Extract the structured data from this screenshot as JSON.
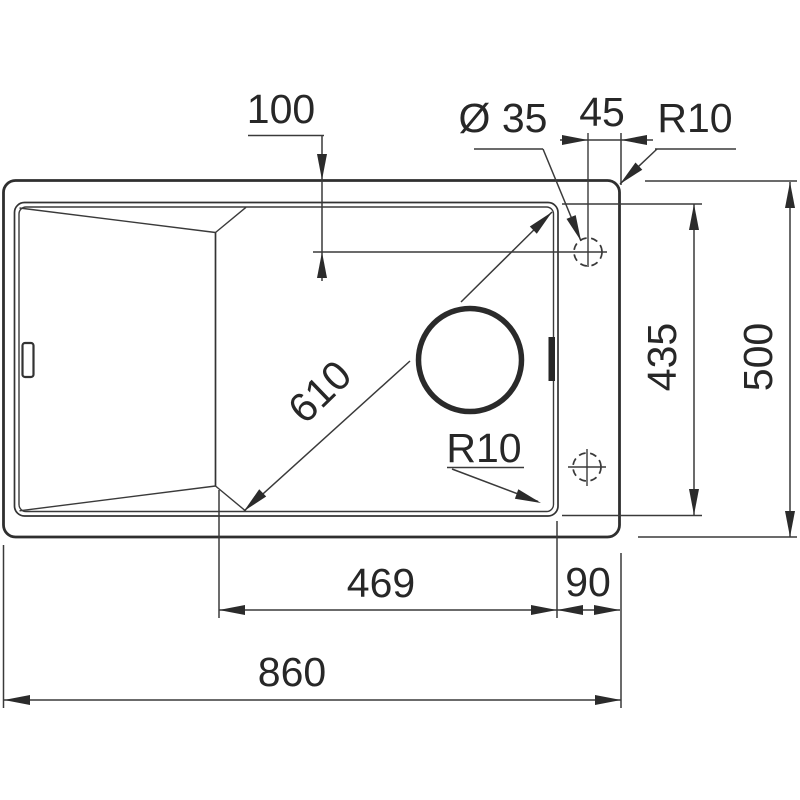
{
  "page": {
    "background": "#ffffff"
  },
  "drawing": {
    "type": "sink-installation-technical-drawing",
    "colors": {
      "line": "#383838",
      "thick_line": "#2f2f2f",
      "text": "#272727",
      "background": "#ffffff"
    },
    "labels": {
      "tap_offset_front": "100",
      "tap_hole_diameter": "Ø 35",
      "tap_offset_right": "45",
      "outer_corner_radius": "R10",
      "bowl_diagonal": "610",
      "bowl_corner_radius": "R10",
      "bowl_front_to_back": "435",
      "overall_front_to_back": "500",
      "bowl_width": "469",
      "bowl_to_edge": "90",
      "overall_width": "860"
    }
  }
}
